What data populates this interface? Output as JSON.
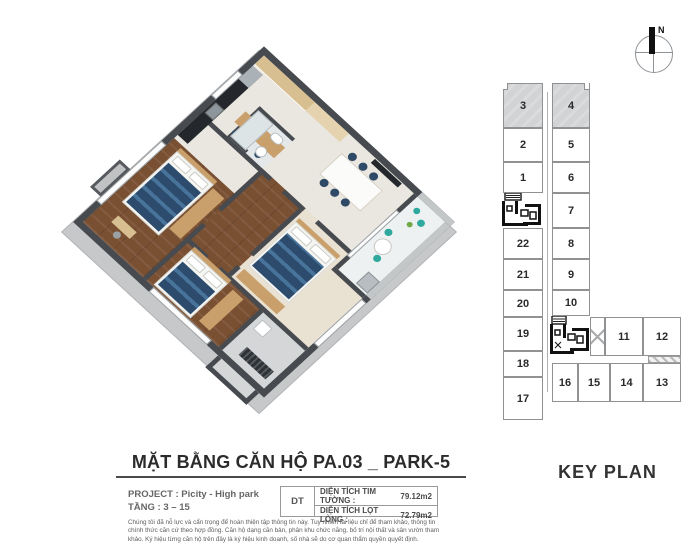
{
  "compass": {
    "north_label": "N"
  },
  "title_block": {
    "title": "MẶT BẰNG CĂN HỘ PA.03 _ PARK-5",
    "project_label": "PROJECT : Picity - High park",
    "floor_label": "TẦNG : 3 – 15"
  },
  "area_table": {
    "code": "DT",
    "rows": [
      {
        "label": "DIỆN TÍCH TIM TƯỜNG :",
        "value": "79.12m2"
      },
      {
        "label": "DIỆN TÍCH LỌT LÒNG :",
        "value": "72.79m2"
      }
    ]
  },
  "disclaimer": "Chúng tôi đã nỗ lực và cẩn trọng để hoàn thiện tập thông tin này. Tuy nhiên tài liệu chỉ để tham khảo, thông tin chính thức căn cứ theo hợp đồng. Căn hộ dạng căn bản, phân khu chức năng, bố trí nội thất và sân vườn tham khảo. Ký hiệu từng căn hộ trên đây là ký hiệu kinh doanh, số nhà sẽ do cơ quan thẩm quyền quyết định.",
  "key_plan": {
    "title": "KEY PLAN",
    "highlighted_units": [
      "3",
      "4"
    ],
    "left_units": [
      "3",
      "2",
      "1",
      "22",
      "21",
      "20",
      "19",
      "18",
      "17"
    ],
    "right_units": [
      "4",
      "5",
      "6",
      "7",
      "8",
      "9",
      "10"
    ],
    "wing_units": [
      "11",
      "12"
    ],
    "bottom_units": [
      "16",
      "15",
      "14",
      "13"
    ]
  },
  "floor_plan": {
    "type": "3d-isometric-apartment",
    "bedrooms": 3,
    "colors": {
      "wall": "#474b50",
      "ground_plate": "#c7c8ca",
      "wood_floor": "#7a5033",
      "tile_floor": "#eae7e0",
      "bed_navy": "#2d4c6d",
      "cabinet_tan": "#c9a06b",
      "kitchen_counter": "#24282c",
      "balcony_teal": "#2fa99e"
    }
  }
}
